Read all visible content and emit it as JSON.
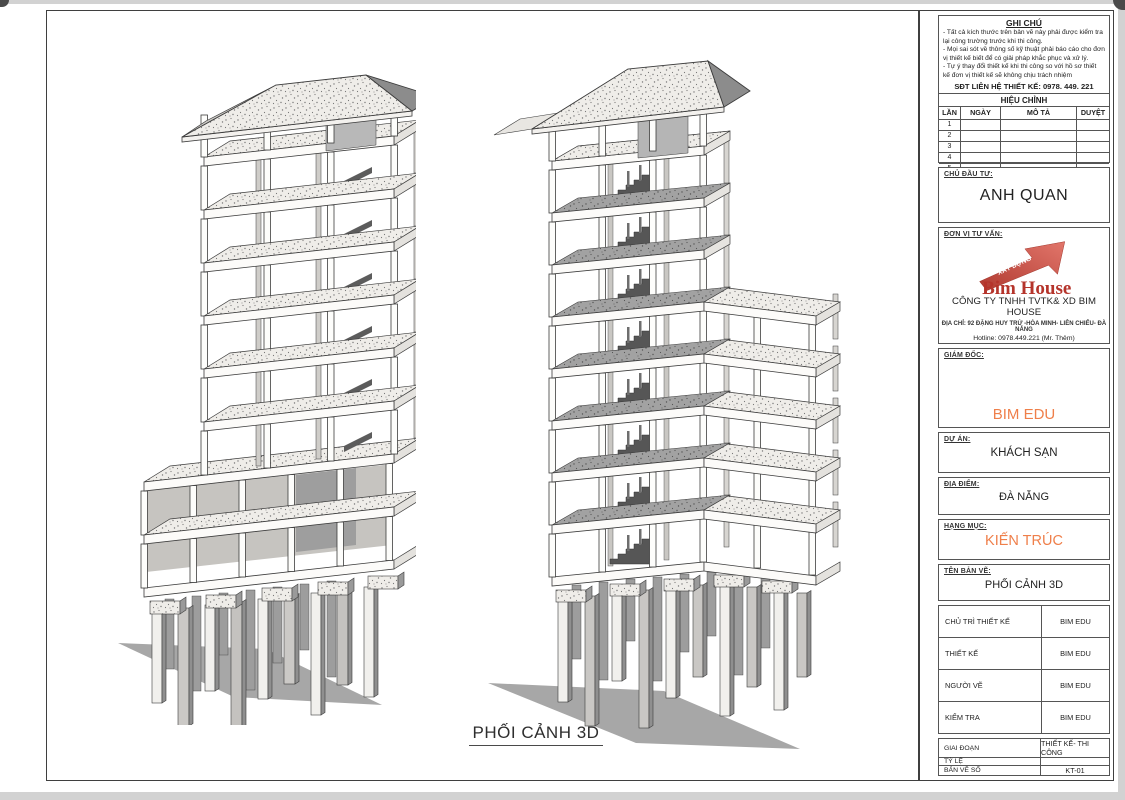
{
  "caption": "PHỐI CẢNH 3D",
  "notes": {
    "title": "GHI CHÚ",
    "lines": [
      "- Tất cả kích thước trên bản vẽ này phải được kiểm tra lại công trường trước khi thi công.",
      "- Mọi sai sót về thông số kỹ thuật phải báo cáo cho đơn vị thiết kế biết để có giải pháp khắc phục và xử lý.",
      "- Tự ý thay đổi thiết kế khi thi công so với hồ sơ thiết kế đơn vị thiết kế sẽ không chịu trách nhiệm"
    ],
    "contact": "SĐT LIÊN HỆ THIẾT KẾ:  0978. 449. 221"
  },
  "revision": {
    "title": "HIỆU CHỈNH",
    "headers": [
      "LẦN",
      "NGÀY",
      "MÔ TẢ",
      "DUYỆT"
    ],
    "rows": [
      "1",
      "2",
      "3",
      "4",
      "5"
    ]
  },
  "owner": {
    "label": "CHỦ ĐẦU TƯ:",
    "value": "ANH QUAN"
  },
  "consultant": {
    "label": "ĐƠN VỊ TƯ VẤN:",
    "logo_arrow_text": "XÂY DỰNG",
    "logo_text": "Bim House",
    "company": "CÔNG TY TNHH TVTK& XD BIM HOUSE",
    "address": "ĐỊA CHỈ: 92 ĐẶNG HUY TRỨ -HÒA MINH- LIÊN CHIỂU- ĐÀ NẴNG",
    "hotline": "Hotline: 0978.449.221 (Mr. Thêm)"
  },
  "director": {
    "label": "GIÁM ĐỐC:",
    "value": "BIM EDU"
  },
  "project": {
    "label": "DỰ ÁN:",
    "value": "KHÁCH SẠN"
  },
  "location": {
    "label": "ĐỊA ĐIỂM:",
    "value": "ĐÀ NẴNG"
  },
  "category": {
    "label": "HẠNG MỤC:",
    "value": "KIẾN TRÚC"
  },
  "drawing_name": {
    "label": "TÊN BẢN VẼ:",
    "value": "PHỐI CẢNH 3D"
  },
  "personnel": {
    "rows": [
      {
        "label": "CHỦ TRÌ THIẾT KẾ",
        "value": "BIM EDU"
      },
      {
        "label": "THIẾT KẾ",
        "value": "BIM EDU"
      },
      {
        "label": "NGƯỜI VẼ",
        "value": "BIM EDU"
      },
      {
        "label": "KIỂM TRA",
        "value": "BIM EDU"
      }
    ]
  },
  "meta": {
    "rows": [
      {
        "label": "GIAI ĐOẠN",
        "value": "THIẾT KẾ- THI CÔNG"
      },
      {
        "label": "TỶ LỆ",
        "value": ""
      },
      {
        "label": "BẢN VẼ SỐ",
        "value": "KT-01"
      }
    ]
  },
  "colors": {
    "accent_orange": "#ef7f4a",
    "logo_red": "#b5342b"
  }
}
